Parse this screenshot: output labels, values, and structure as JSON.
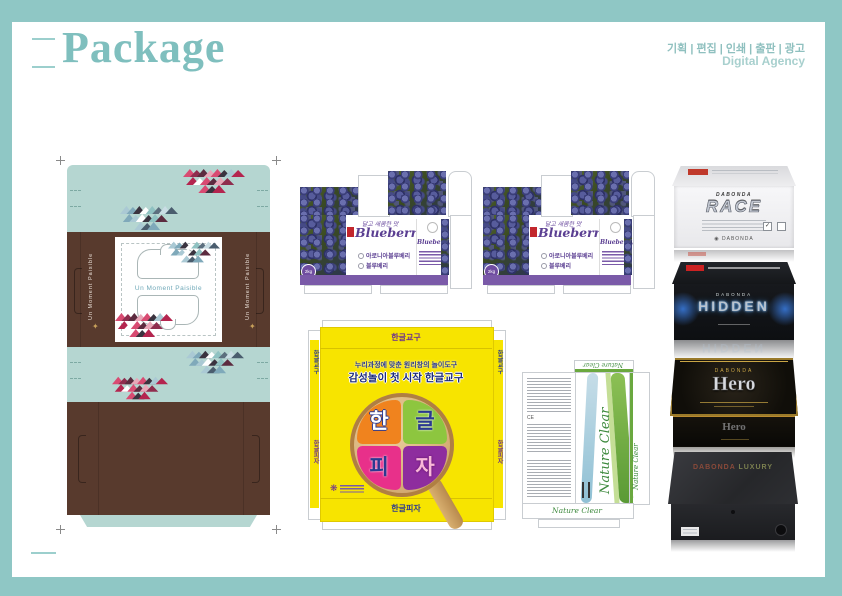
{
  "header": {
    "title": "Package",
    "services": "기획 | 편집 | 인쇄 | 출판 | 광고",
    "agency": "Digital Agency",
    "accent_color": "#8fc7c5"
  },
  "moment": {
    "title": "Un Moment Paisible",
    "colors": {
      "mint": "#b5d6d1",
      "brown": "#583a2d"
    }
  },
  "blueberry": {
    "script": "달고 새콤한 맛",
    "title": "Blueberry",
    "bullet1": "아로니아블루베리",
    "bullet2": "블루베리",
    "weight": "2kg",
    "band_color": "#7a5aa8"
  },
  "hangul": {
    "flap_logo": "한글교구",
    "line1": "누리과정에 맞춘 원리창의 놀이도구",
    "line2": "감성놀이 첫 시작 한글교구",
    "slice1": "한",
    "slice2": "글",
    "slice3": "피",
    "slice4": "자",
    "bottom_text": "한글피자",
    "bg_color": "#f7e400"
  },
  "nature": {
    "title": "Nature Clear"
  },
  "boxes": [
    {
      "brand": "DABONDA",
      "name": "RACE"
    },
    {
      "brand": "DABONDA",
      "name": "HIDDEN"
    },
    {
      "brand": "DABONDA",
      "name": "Hero"
    },
    {
      "brand": "DABONDA",
      "name": "LUXURY"
    }
  ],
  "icons": {
    "check": "✓",
    "brand_mark": "◉",
    "gold_mark": "✦"
  }
}
